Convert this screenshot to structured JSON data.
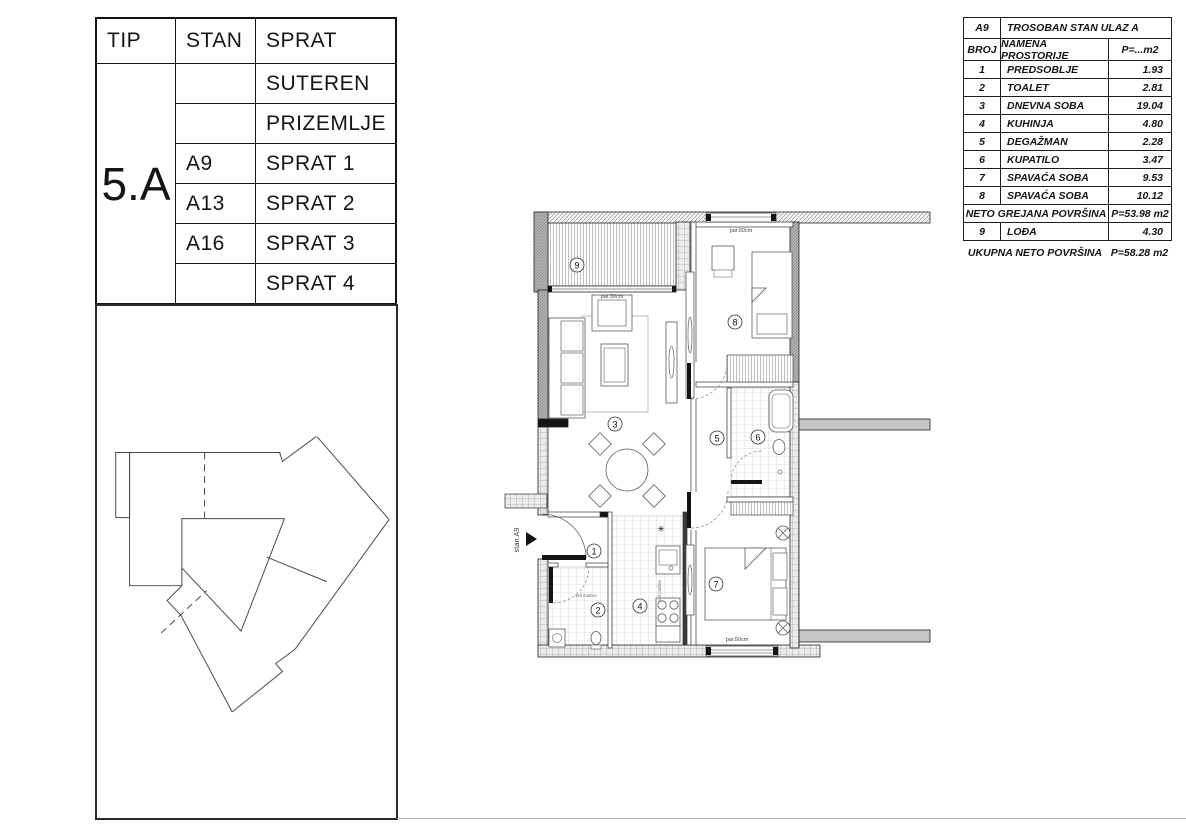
{
  "left_table": {
    "headers": {
      "tip": "TIP",
      "stan": "STAN",
      "sprat": "SPRAT"
    },
    "tip_value": "5.A",
    "rows": [
      {
        "stan": "",
        "sprat": "SUTEREN"
      },
      {
        "stan": "",
        "sprat": "PRIZEMLJE"
      },
      {
        "stan": "A9",
        "sprat": "SPRAT 1"
      },
      {
        "stan": "A13",
        "sprat": "SPRAT 2"
      },
      {
        "stan": "A16",
        "sprat": "SPRAT 3"
      },
      {
        "stan": "",
        "sprat": "SPRAT 4"
      }
    ]
  },
  "room_table": {
    "unit_id": "A9",
    "unit_title": "TROSOBAN STAN ULAZ A",
    "col_headers": {
      "broj": "BROJ",
      "namena": "NAMENA PROSTORIJE",
      "area": "P=...m2"
    },
    "rooms": [
      {
        "broj": "1",
        "namena": "PREDSOBLJE",
        "area": "1.93"
      },
      {
        "broj": "2",
        "namena": "TOALET",
        "area": "2.81"
      },
      {
        "broj": "3",
        "namena": "DNEVNA SOBA",
        "area": "19.04"
      },
      {
        "broj": "4",
        "namena": "KUHINJA",
        "area": "4.80"
      },
      {
        "broj": "5",
        "namena": "DEGAŽMAN",
        "area": "2.28"
      },
      {
        "broj": "6",
        "namena": "KUPATILO",
        "area": "3.47"
      },
      {
        "broj": "7",
        "namena": "SPAVAĆA SOBA",
        "area": "9.53"
      },
      {
        "broj": "8",
        "namena": "SPAVAĆA SOBA",
        "area": "10.12"
      }
    ],
    "neto_grejana": {
      "label": "NETO GREJANA POVRŠINA",
      "value": "P=53.98 m2"
    },
    "lodja_row": {
      "broj": "9",
      "namena": "LOĐA",
      "area": "4.30"
    },
    "ukupna": {
      "label": "UKUPNA NETO POVRŠINA",
      "value": "P=58.28 m2"
    }
  },
  "floorplan": {
    "labels": {
      "unit": "stan A9",
      "balcony_parapet": "par.30cm",
      "top_window": "par.60cm",
      "bottom_window": "par.50cm",
      "washer": "veš mašina",
      "dishwasher": "sud mašina",
      "vent_star": "✳"
    },
    "numbers": {
      "n1": "1",
      "n2": "2",
      "n3": "3",
      "n4": "4",
      "n5": "5",
      "n6": "6",
      "n7": "7",
      "n8": "8",
      "n9": "9"
    }
  }
}
